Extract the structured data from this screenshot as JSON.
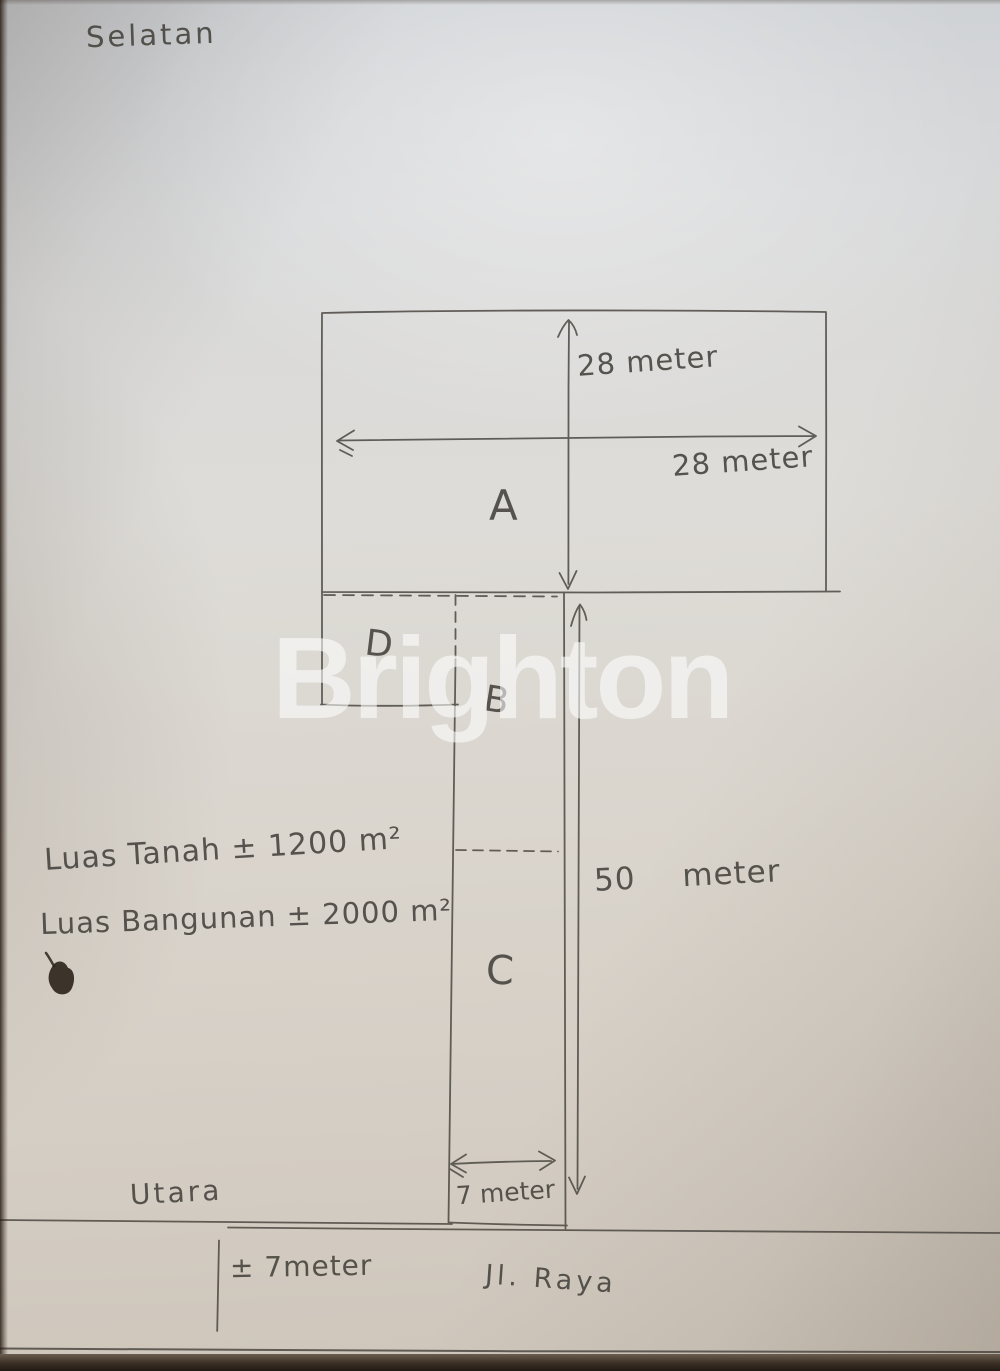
{
  "watermark": "Brighton",
  "plan": {
    "direction_top": "Selatan",
    "direction_bottom": "Utara",
    "sections": {
      "a": "A",
      "b": "B",
      "c": "C",
      "d": "D"
    },
    "dims": {
      "a_depth": "28 meter",
      "a_width": "28 meter",
      "strip_length": "50 meter",
      "strip_width": "7 meter",
      "road_width": "± 7meter"
    },
    "road_name": "Jl. Raya",
    "notes": {
      "land_area": "Luas Tanah ± 1200 m²",
      "building_area": "Luas Bangunan ± 2000 m²"
    }
  },
  "colors": {
    "ink": "#45423d",
    "paper": "#d8d4cd",
    "watermark": "#ffffff"
  }
}
